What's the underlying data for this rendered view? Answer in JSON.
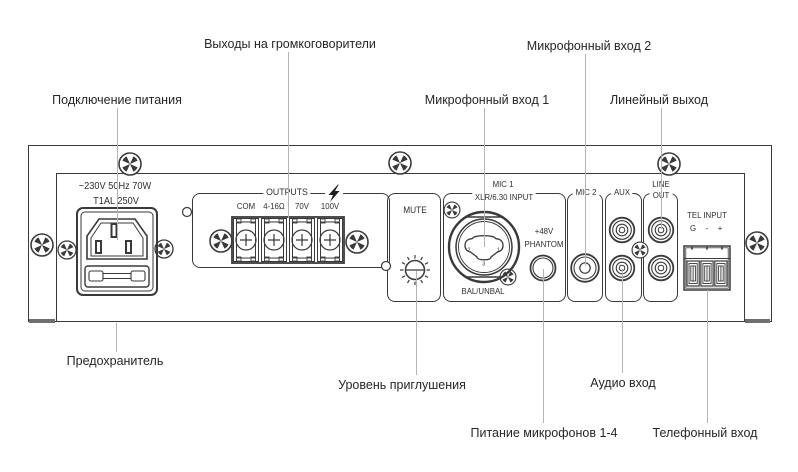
{
  "colors": {
    "line": "#3a3a3a",
    "leader": "#b4b4b4",
    "text": "#262626"
  },
  "callouts": {
    "power": "Подключение питания",
    "speaker_outputs": "Выходы на громкоговорители",
    "mic1": "Микрофонный вход 1",
    "mic2": "Микрофонный вход 2",
    "line_out": "Линейный выход",
    "fuse": "Предохранитель",
    "mute_level": "Уровень приглушения",
    "audio_in": "Аудио вход",
    "phantom_power": "Питание микрофонов 1-4",
    "tel_in": "Телефонный вход"
  },
  "panel": {
    "power_rating": "~230V 50Hz 70W",
    "fuse_rating": "T1AL 250V",
    "outputs": {
      "title": "OUTPUTS",
      "terminals": [
        "COM",
        "4-16Ω",
        "70V",
        "100V"
      ]
    },
    "mute": "MUTE",
    "mic1": {
      "title": "MIC 1",
      "subtitle": "XLR/6.30 INPUT",
      "mode": "BAL/UNBAL",
      "pin_left": "2",
      "pin_right": "1",
      "pin_bottom": "3",
      "phantom_top": "+48V",
      "phantom_bottom": "PHANTOM"
    },
    "mic2": "MIC 2",
    "aux": "AUX",
    "line_out_line1": "LINE",
    "line_out_line2": "OUT",
    "tel": {
      "title": "TEL INPUT",
      "g": "G",
      "minus": "-",
      "plus": "+"
    }
  }
}
